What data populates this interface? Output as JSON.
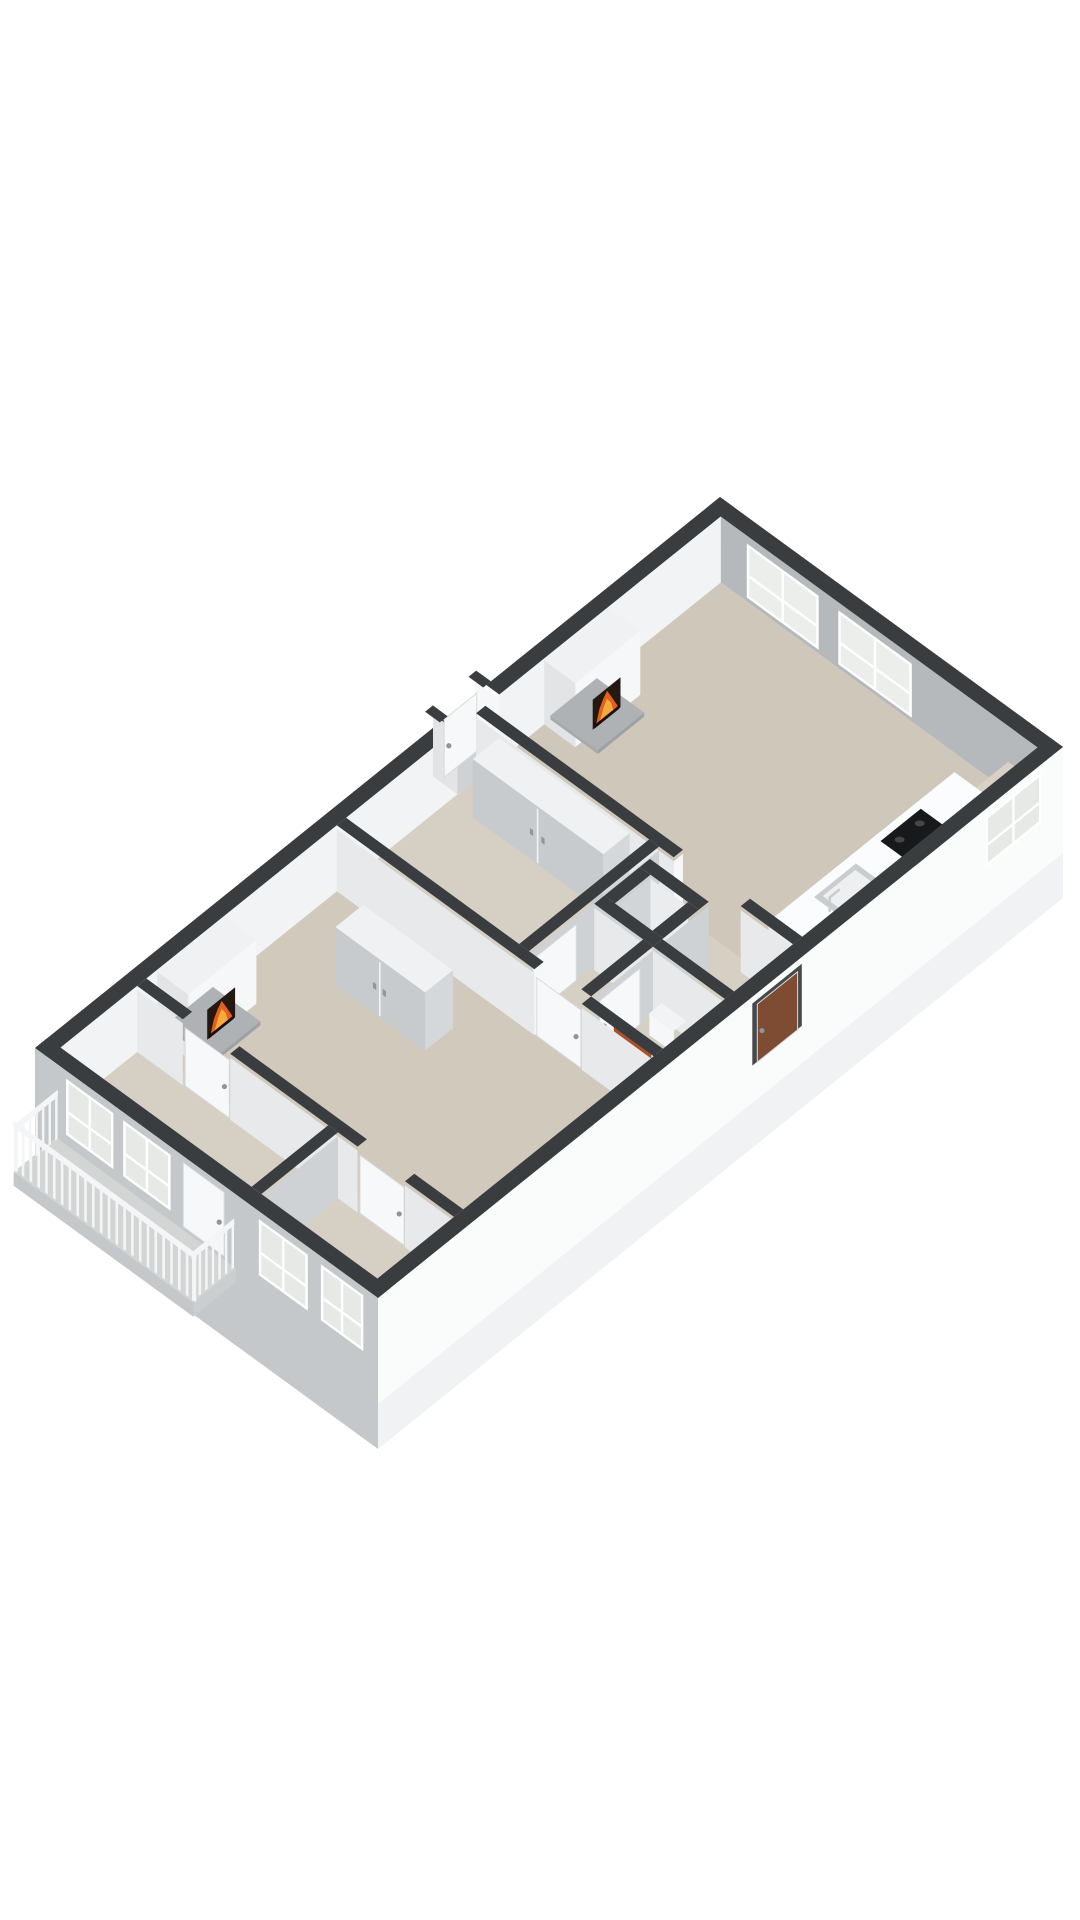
{
  "meta": {
    "kind": "3d-floorplan-render",
    "background": "#ffffff",
    "canvas": [
      1080,
      1920
    ]
  },
  "palette": {
    "dark": "#3a3d40",
    "seIn": "#eff1f2",
    "neIn": "#b5b9bc",
    "nwIn": "#f2f3f5",
    "floor1": "#cfc7ba",
    "floor1b": "#d1c9bc",
    "floor2": "#d6cfc3",
    "hallF": "#d8d2c7",
    "recessF": "#cfd2d4",
    "white": "#f6f7f8",
    "shade1": "#e2e4e6",
    "fSW": "#e7e9ea",
    "fSE": "#ced2d4",
    "glass": "#eceeec",
    "glass2": "#e7e9e6",
    "frame": "#ffffff",
    "sill": "#d9d1c4",
    "sillF": "#e8e1d5",
    "sillS": "#ddd6ca",
    "counterF": "#f1f3f4",
    "counterS": "#e9ebec",
    "counterT": "#fbfcfd",
    "cook": "#17191b",
    "burner": "#43474a",
    "sinkM": "#c9cdcf",
    "sinkI": "#edeff0",
    "hearth": "#aeb2b5",
    "hearthE": "#9da1a4",
    "hearthE2": "#a6aaad",
    "wardT": "#eff1f2",
    "ward": "#c7cbce",
    "wardE": "#d5d8da",
    "seam": "#f1f3f4",
    "handleF": "#90969b",
    "shaftIn1": "#d2d5d7",
    "shaftIn2": "#eaecee",
    "orange": "#a9512b",
    "orangeT": "#b45c33",
    "orangeD": "#8d401f",
    "pipe": "#2c2e30",
    "toiletB": "#fafbfc",
    "toiletR": "#e8eaeb",
    "facadeSE": "#fafbfb",
    "facadeSEl": "#f1f2f3",
    "doorRecess": "#46484a",
    "brown": "#7e4b33",
    "swIn": "#c9cdd0",
    "facadeSW": "#c4c8cb",
    "balcF": "#d3d5d4",
    "balcE": "#c5c8ca",
    "balcE2": "#cbced0",
    "rail": "#f4f5f6",
    "doorW": "#f7f8f9",
    "doorEdge": "#d8dbdd",
    "handle": "#8f959a",
    "fireDark": "#241812",
    "fireO": "#e2611c",
    "fireY": "#f6aa3d",
    "log": "#1a0f08"
  },
  "proj": {
    "origin": [
      720,
      563
    ],
    "u": [
      0.8167,
      0.5952
    ],
    "v": [
      -0.774,
      0.6226
    ],
    "h": 66
  },
  "building": {
    "width": 420,
    "length": 885,
    "ext_wall": 16,
    "int_wall": 12,
    "facade_depth": 85
  },
  "ops": [
    [
      "g",
      "se-wall-inner"
    ],
    [
      "fu",
      404,
      16,
      869,
      0,
      66,
      "seIn"
    ],
    [
      "wu",
      404,
      28,
      100,
      8,
      58,
      "glass"
    ],
    [
      "g",
      "ne-wall-inner"
    ],
    [
      "fv",
      16,
      16,
      404,
      0,
      66,
      "neIn"
    ],
    [
      "wv",
      16,
      48,
      136,
      4,
      58,
      "glass"
    ],
    [
      "wv",
      16,
      160,
      250,
      4,
      58,
      "glass"
    ],
    [
      "g",
      "nw-wall-inner"
    ],
    [
      "fu",
      16,
      16,
      869,
      0,
      66,
      "nwIn"
    ],
    [
      "g",
      "floors"
    ],
    [
      "fl",
      16,
      16,
      404,
      332,
      0,
      "floor1"
    ],
    [
      "fl",
      16,
      320,
      404,
      512,
      0,
      "floor2"
    ],
    [
      "fl",
      16,
      500,
      404,
      770,
      0,
      "floor1b"
    ],
    [
      "fl",
      16,
      758,
      404,
      869,
      0,
      "floor2"
    ],
    [
      "g",
      "exterior-wall-tops"
    ],
    [
      "bd",
      0,
      0,
      420,
      16
    ],
    [
      "bd",
      0,
      0,
      16,
      302
    ],
    [
      "bd",
      0,
      356,
      16,
      885
    ],
    [
      "g",
      "entry-recess"
    ],
    [
      "fl",
      -14,
      302,
      16,
      356,
      0,
      "recessF"
    ],
    [
      "fv",
      302,
      -14,
      16,
      0,
      62,
      "white"
    ],
    [
      "fv",
      356,
      -14,
      16,
      0,
      62,
      "shade1"
    ],
    [
      "du",
      -6,
      308,
      350,
      0,
      58,
      "doorW"
    ],
    [
      "bd",
      -18,
      296,
      0,
      306
    ],
    [
      "bd",
      -18,
      352,
      0,
      362
    ],
    [
      "g",
      "kitchen-sill"
    ],
    [
      "fu",
      368,
      16,
      58,
      0,
      30,
      "sillF"
    ],
    [
      "fv",
      58,
      368,
      404,
      0,
      30,
      "sillS"
    ],
    [
      "fl",
      368,
      16,
      404,
      58,
      30,
      "sill"
    ],
    [
      "g",
      "kitchen-counter"
    ],
    [
      "fu",
      344,
      60,
      300,
      0,
      33,
      "counterF"
    ],
    [
      "fv",
      300,
      344,
      404,
      0,
      33,
      "counterS"
    ],
    [
      "fl",
      344,
      60,
      404,
      300,
      33,
      "counterT"
    ],
    [
      "fl",
      352,
      112,
      398,
      164,
      33.5,
      "cook"
    ],
    [
      "el",
      363,
      125,
      33.5,
      5,
      3,
      "burner"
    ],
    [
      "el",
      363,
      151,
      33.5,
      5,
      3,
      "burner"
    ],
    [
      "el",
      387,
      125,
      33.5,
      5,
      3,
      "burner"
    ],
    [
      "el",
      387,
      151,
      33.5,
      5,
      3,
      "burner"
    ],
    [
      "fl",
      354,
      198,
      396,
      252,
      33.5,
      "sinkM"
    ],
    [
      "fl",
      359,
      204,
      391,
      246,
      33.8,
      "sinkI"
    ],
    [
      "ln",
      375,
      254,
      33.5,
      375,
      254,
      47,
      2.5,
      "sinkM"
    ],
    [
      "ln",
      375,
      254,
      47,
      375,
      242,
      47,
      2.5,
      "sinkM"
    ],
    [
      "g",
      "fireplace-kitchen-living"
    ],
    [
      "fu",
      54,
      160,
      244,
      0,
      64,
      "white"
    ],
    [
      "fv",
      244,
      16,
      54,
      0,
      64,
      "shade1"
    ],
    [
      "fl",
      16,
      160,
      54,
      244,
      64,
      "wardT"
    ],
    [
      "fl",
      16,
      176,
      74,
      236,
      4,
      "hearth"
    ],
    [
      "fu",
      74,
      176,
      236,
      0,
      4,
      "hearthE"
    ],
    [
      "fv",
      236,
      16,
      74,
      0,
      4,
      "hearthE2"
    ],
    [
      "fi",
      54.5,
      186,
      222,
      4,
      34
    ],
    [
      "g",
      "partition-living-kitchen"
    ],
    [
      "fv",
      332,
      16,
      258,
      0,
      62,
      "fSW"
    ],
    [
      "fv",
      332,
      340,
      404,
      0,
      62,
      "fSW"
    ],
    [
      "fu",
      258,
      320,
      332,
      0,
      62,
      "white"
    ],
    [
      "bd",
      16,
      320,
      258,
      332
    ],
    [
      "bd",
      340,
      320,
      404,
      332
    ],
    [
      "g",
      "wardrobe-middle-bedroom"
    ],
    [
      "fl",
      44,
      332,
      204,
      366,
      58,
      "wardT"
    ],
    [
      "fu",
      204,
      332,
      366,
      0,
      58,
      "wardE"
    ],
    [
      "fv",
      366,
      44,
      204,
      0,
      58,
      "ward"
    ],
    [
      "fv",
      366.5,
      123,
      125,
      2,
      56,
      "seam"
    ],
    [
      "fv",
      367,
      115,
      119,
      26,
      32,
      "handleF"
    ],
    [
      "fv",
      367,
      129,
      133,
      26,
      32,
      "handleF"
    ],
    [
      "g",
      "partition-bedroom-hall"
    ],
    [
      "fu",
      240,
      332,
      500,
      0,
      62,
      "fSE"
    ],
    [
      "bd",
      228,
      332,
      240,
      500
    ],
    [
      "du",
      241,
      440,
      496,
      0,
      56,
      "doorW"
    ],
    [
      "g",
      "shaft"
    ],
    [
      "fl",
      257,
      361,
      303,
      407,
      0,
      "hallF"
    ],
    [
      "fu",
      257,
      361,
      407,
      0,
      62,
      "shaftIn1"
    ],
    [
      "fv",
      361,
      257,
      303,
      0,
      62,
      "shaftIn2"
    ],
    [
      "fu",
      316,
      348,
      420,
      0,
      62,
      "fSE"
    ],
    [
      "fv",
      420,
      244,
      316,
      0,
      62,
      "fSW"
    ],
    [
      "bd",
      244,
      348,
      316,
      361
    ],
    [
      "bd",
      244,
      407,
      316,
      420
    ],
    [
      "bd",
      244,
      361,
      257,
      407
    ],
    [
      "bd",
      303,
      361,
      316,
      407
    ],
    [
      "g",
      "wall-corridor"
    ],
    [
      "fv",
      420,
      316,
      404,
      0,
      62,
      "fSW"
    ],
    [
      "bd",
      316,
      408,
      404,
      420
    ],
    [
      "g",
      "wall-wc"
    ],
    [
      "fu",
      316,
      420,
      500,
      0,
      62,
      "fSE"
    ],
    [
      "bd",
      304,
      420,
      316,
      500
    ],
    [
      "du",
      317,
      438,
      490,
      0,
      56,
      "doorW"
    ],
    [
      "g",
      "toilet"
    ],
    [
      "fv",
      448,
      338,
      368,
      8,
      30,
      "white"
    ],
    [
      "fl",
      338,
      432,
      368,
      448,
      30,
      "counterF"
    ],
    [
      "el",
      353,
      461,
      1,
      13,
      8,
      "toiletB"
    ],
    [
      "el",
      353,
      460,
      1.5,
      8.5,
      5,
      "toiletR"
    ],
    [
      "g",
      "radiator"
    ],
    [
      "fv",
      496,
      340,
      386,
      2,
      50,
      "orange"
    ],
    [
      "fl",
      340,
      488,
      386,
      496,
      50,
      "orangeT"
    ],
    [
      "fv",
      496.5,
      343,
      383,
      12,
      14,
      "orangeD"
    ],
    [
      "fv",
      496.5,
      343,
      383,
      22,
      24,
      "orangeD"
    ],
    [
      "fv",
      496.5,
      343,
      383,
      32,
      34,
      "orangeD"
    ],
    [
      "fv",
      497,
      390,
      393,
      0,
      56,
      "pipe"
    ],
    [
      "fv",
      497,
      396,
      399,
      0,
      56,
      "pipe"
    ],
    [
      "g",
      "partition-hall-living"
    ],
    [
      "fv",
      512,
      16,
      258,
      0,
      62,
      "fSW"
    ],
    [
      "fv",
      512,
      316,
      404,
      0,
      62,
      "fSW"
    ],
    [
      "fu",
      258,
      500,
      512,
      0,
      62,
      "white"
    ],
    [
      "bd",
      16,
      500,
      258,
      512
    ],
    [
      "bd",
      316,
      500,
      404,
      512
    ],
    [
      "dv",
      511,
      260,
      314,
      0,
      58,
      "doorW"
    ],
    [
      "g",
      "wardrobe-living"
    ],
    [
      "fl",
      90,
      556,
      200,
      592,
      58,
      "wardT"
    ],
    [
      "fu",
      200,
      556,
      592,
      0,
      58,
      "wardE"
    ],
    [
      "fv",
      592,
      90,
      200,
      0,
      58,
      "ward"
    ],
    [
      "fv",
      592.5,
      144,
      146,
      2,
      56,
      "seam"
    ],
    [
      "fv",
      593,
      137,
      141,
      26,
      32,
      "handleF"
    ],
    [
      "fv",
      593,
      149,
      153,
      26,
      32,
      "handleF"
    ],
    [
      "g",
      "fireplace-living"
    ],
    [
      "fu",
      54,
      656,
      744,
      0,
      64,
      "white"
    ],
    [
      "fv",
      744,
      16,
      54,
      0,
      64,
      "shade1"
    ],
    [
      "fl",
      16,
      656,
      54,
      744,
      64,
      "wardT"
    ],
    [
      "fl",
      16,
      672,
      74,
      732,
      4,
      "hearth"
    ],
    [
      "fu",
      74,
      672,
      732,
      0,
      4,
      "hearthE"
    ],
    [
      "fv",
      732,
      16,
      74,
      0,
      4,
      "hearthE2"
    ],
    [
      "fi",
      54.5,
      684,
      720,
      4,
      34
    ],
    [
      "g",
      "wall-bedrooms"
    ],
    [
      "fv",
      770,
      16,
      72,
      0,
      62,
      "fSW"
    ],
    [
      "fv",
      770,
      130,
      286,
      0,
      62,
      "fSW"
    ],
    [
      "fv",
      770,
      344,
      404,
      0,
      62,
      "fSW"
    ],
    [
      "bd",
      16,
      758,
      72,
      770
    ],
    [
      "bd",
      130,
      758,
      286,
      770
    ],
    [
      "bd",
      344,
      758,
      404,
      770
    ],
    [
      "dv",
      769,
      74,
      128,
      0,
      58,
      "doorW"
    ],
    [
      "dv",
      769,
      288,
      342,
      0,
      58,
      "doorW"
    ],
    [
      "g",
      "wall-bedroom-split"
    ],
    [
      "fu",
      262,
      770,
      869,
      0,
      62,
      "fSE"
    ],
    [
      "bd",
      250,
      770,
      262,
      869
    ],
    [
      "g",
      "se-facade"
    ],
    [
      "bd",
      404,
      0,
      420,
      885
    ],
    [
      "fu",
      420,
      0,
      885,
      -85,
      66,
      "facadeSE"
    ],
    [
      "fu",
      420,
      0,
      885,
      -85,
      -40,
      "facadeSEl"
    ],
    [
      "wu",
      420,
      28,
      100,
      8,
      58,
      "glass2"
    ],
    [
      "fu",
      420.5,
      338,
      402,
      -2,
      60,
      "doorRecess"
    ],
    [
      "du",
      421,
      344,
      396,
      -2,
      56,
      "brown"
    ],
    [
      "g",
      "sw-wall-interior"
    ],
    [
      "fv",
      869,
      16,
      404,
      0,
      66,
      "swIn"
    ],
    [
      "wv",
      869,
      38,
      96,
      6,
      58,
      "glass"
    ],
    [
      "wv",
      869,
      108,
      166,
      6,
      58,
      "glass"
    ],
    [
      "wv",
      869,
      274,
      334,
      6,
      58,
      "glass"
    ],
    [
      "wv",
      869,
      350,
      402,
      6,
      58,
      "glass"
    ],
    [
      "dv",
      869,
      182,
      232,
      0,
      62,
      "doorW"
    ],
    [
      "g",
      "sw-facade"
    ],
    [
      "bd",
      0,
      869,
      420,
      885
    ],
    [
      "fv",
      885,
      0,
      420,
      -85,
      66,
      "facadeSW"
    ],
    [
      "wv",
      885,
      38,
      96,
      2,
      58,
      "glass2"
    ],
    [
      "wv",
      885,
      108,
      166,
      2,
      58,
      "glass2"
    ],
    [
      "wv",
      885,
      274,
      334,
      2,
      58,
      "glass2"
    ],
    [
      "wv",
      885,
      350,
      402,
      2,
      58,
      "glass2"
    ],
    [
      "dv",
      885.5,
      182,
      232,
      -4,
      60,
      "doorW"
    ],
    [
      "g",
      "balcony"
    ],
    [
      "fl",
      26,
      885,
      246,
      940,
      -8,
      "balcF"
    ],
    [
      "fv",
      940,
      26,
      246,
      -22,
      -8,
      "balcE"
    ],
    [
      "fu",
      246,
      885,
      940,
      -22,
      -8,
      "balcE2"
    ],
    [
      "pu",
      28,
      887,
      938,
      -8,
      34,
      7
    ],
    [
      "fu",
      28,
      885,
      940,
      34,
      41,
      "rail"
    ],
    [
      "pu",
      244,
      887,
      938,
      -8,
      34,
      7
    ],
    [
      "fu",
      244,
      885,
      940,
      34,
      41,
      "rail"
    ],
    [
      "pv",
      938,
      26,
      246,
      -8,
      34,
      24
    ],
    [
      "fv",
      938,
      24,
      248,
      34,
      41,
      "rail"
    ]
  ]
}
